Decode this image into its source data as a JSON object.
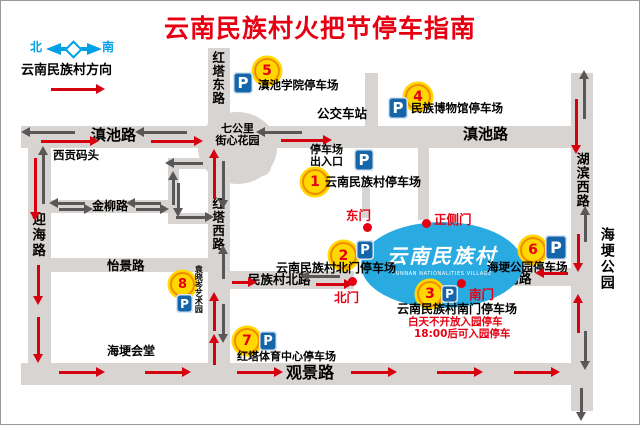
{
  "title": "云南民族村火把节停车指南",
  "p_letter": "P",
  "compass": {
    "north": "北",
    "south": "南",
    "direction_label": "云南民族村方向"
  },
  "village": {
    "name": "云南民族村",
    "name_en": "YUNNAN NATIONALITIES VILLAGE"
  },
  "gates": {
    "east": "东门",
    "front": "正侧门",
    "north": "北门",
    "south": "南门"
  },
  "roads": {
    "dianchi_w": "滇池路",
    "dianchi_e": "滇池路",
    "hongta_e": "红塔东路",
    "hongta_w": "红塔西路",
    "yinghai": "迎海路",
    "jinliu": "金柳路",
    "yijing": "怡景路",
    "guanjing": "观景路",
    "hubin_w": "湖滨西路",
    "mzc_north": "民族村北路",
    "mzc_south": "民族村南路"
  },
  "landmarks": {
    "roundabout_l1": "七公里",
    "roundabout_l2": "街心花园",
    "xigong": "西贡码头",
    "bus_station": "公交车站",
    "haigeng_hall": "海埂会堂",
    "haigeng_park": "海埂公园",
    "entrance_l1": "停车场",
    "entrance_l2": "出入口"
  },
  "parkings": {
    "p1": {
      "num": "1",
      "label": "云南民族村停车场"
    },
    "p2": {
      "num": "2",
      "label": "云南民族村北门停车场"
    },
    "p3": {
      "num": "3",
      "label": "云南民族村南门停车场",
      "note1": "白天不开放入园停车",
      "note2": "18:00后可入园停车"
    },
    "p4": {
      "num": "4",
      "label": "民族博物馆停车场"
    },
    "p5": {
      "num": "5",
      "label": "滇池学院停车场"
    },
    "p6": {
      "num": "6",
      "label": "海埂公园停车场"
    },
    "p7": {
      "num": "7",
      "label": "红塔体育中心停车场"
    },
    "p8": {
      "num": "8",
      "label": "袁晓岑艺术园"
    }
  }
}
